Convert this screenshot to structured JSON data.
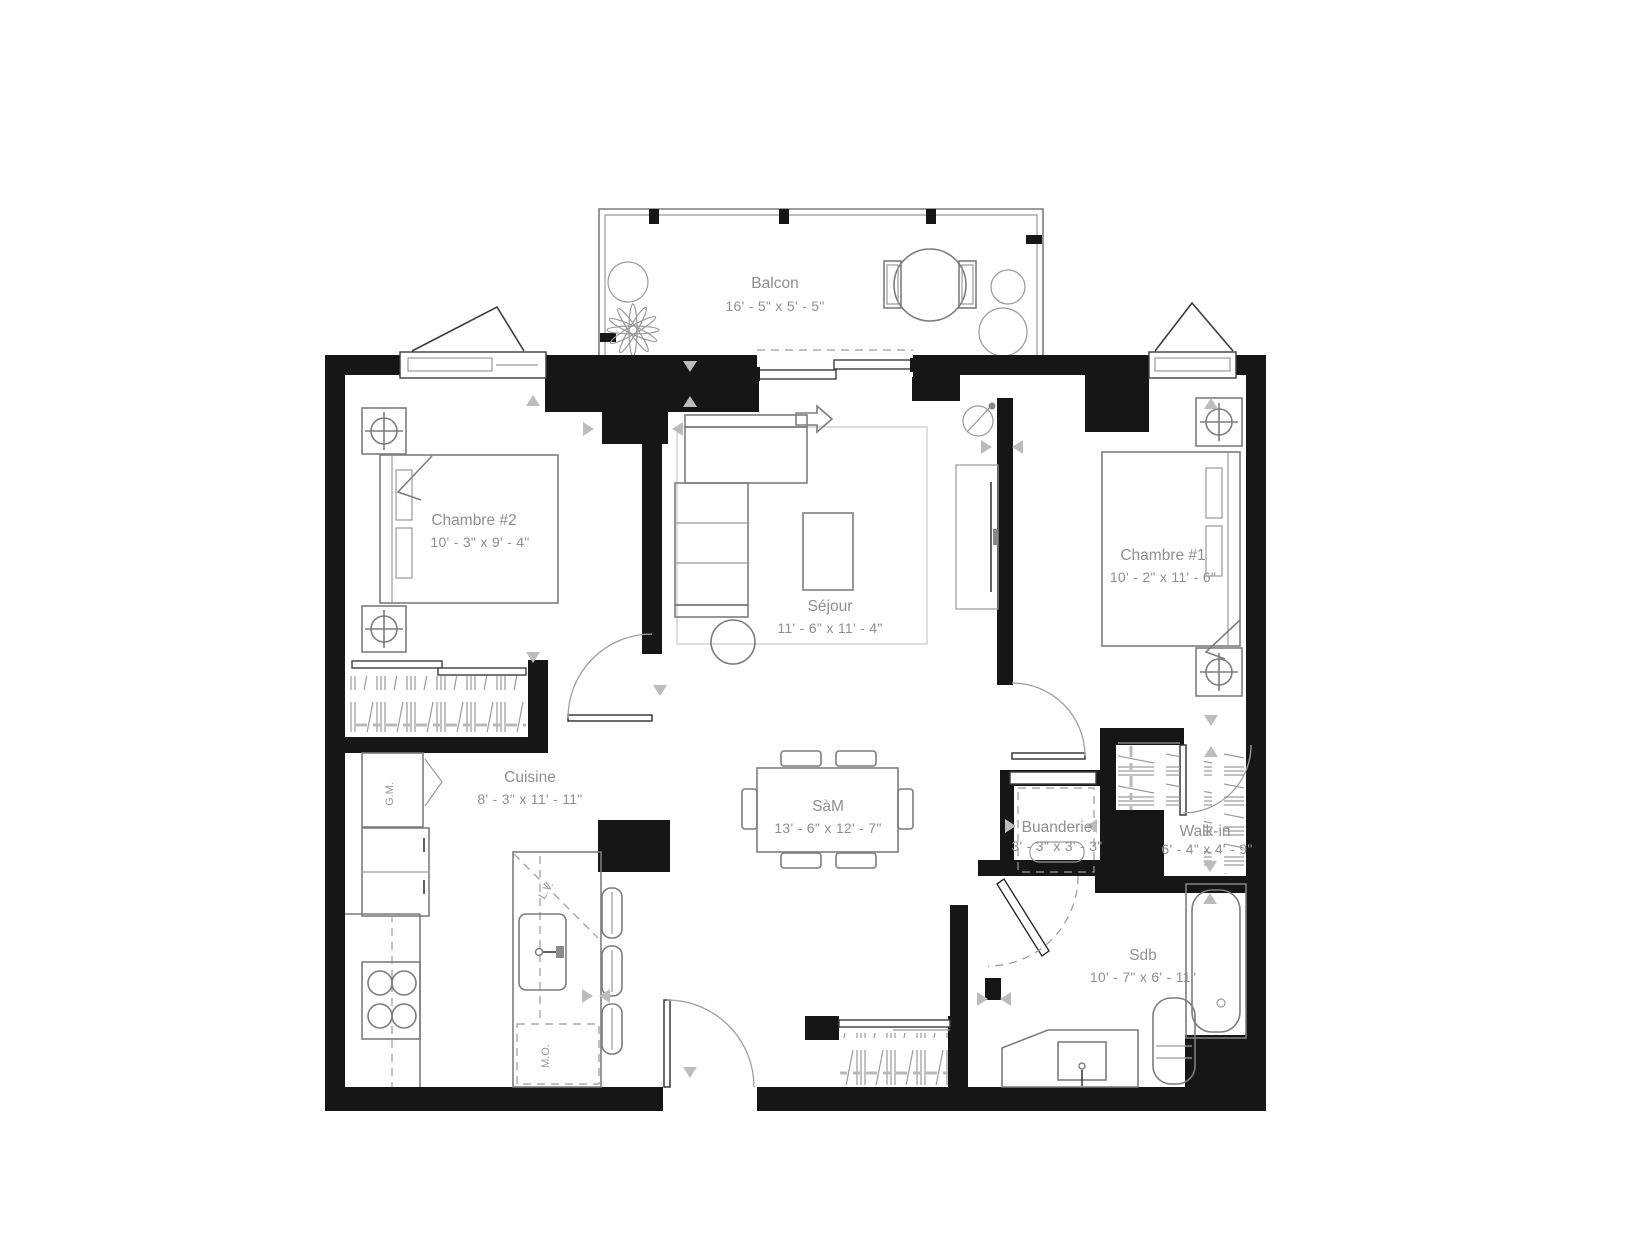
{
  "rooms": {
    "balcon": {
      "name": "Balcon",
      "dims": "16' - 5\" x 5' - 5\""
    },
    "chambre2": {
      "name": "Chambre #2",
      "dims": "10' - 3\" x 9' - 4\""
    },
    "sejour": {
      "name": "Séjour",
      "dims": "11' - 6\" x 11' - 4\""
    },
    "chambre1": {
      "name": "Chambre #1",
      "dims": "10' - 2\" x 11' - 6\""
    },
    "cuisine": {
      "name": "Cuisine",
      "dims": "8' - 3\" x 11' - 11\""
    },
    "sam": {
      "name": "SàM",
      "dims": "13' - 6\" x 12' - 7\""
    },
    "buanderie": {
      "name": "Buanderie",
      "dims": "3' - 3\" x 3' - 3\""
    },
    "walkin": {
      "name": "Walk-in",
      "dims": "6' - 4\" x 4' - 9\""
    },
    "sdb": {
      "name": "Sdb",
      "dims": "10' - 7\" x 6' - 11\""
    }
  },
  "appliances": {
    "garde_manger": "G.M.",
    "lave_vaisselle": "L.V.",
    "micro_ondes": "M.O."
  },
  "colors": {
    "wall": "#161616",
    "furniture_line": "#7d7d7d",
    "label_text": "#8f8f8f",
    "background": "#ffffff"
  }
}
